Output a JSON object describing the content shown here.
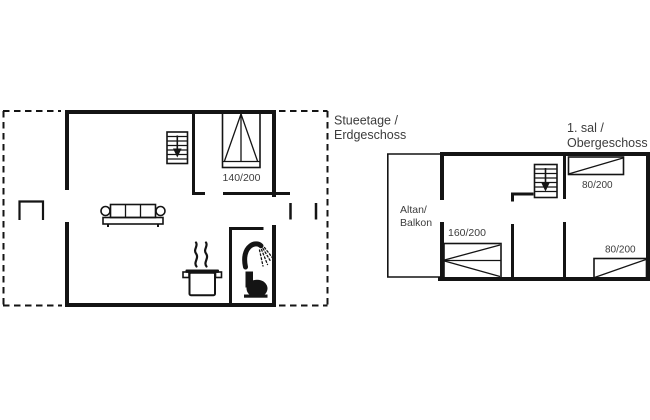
{
  "document": {
    "type": "vacation-house floor plan, two storeys",
    "background_color": "#ffffff",
    "line_color": "#141414",
    "text_color": "#3c3c3c"
  },
  "ground_floor": {
    "title": [
      "Stueetage /",
      "Erdgeschoss"
    ],
    "bed_size": "140/200"
  },
  "upper_floor": {
    "title": [
      "1. sal /",
      "Obergeschoss"
    ],
    "balcony_label": [
      "Altan/",
      "Balkon"
    ],
    "bed_sizes": {
      "bedroom_right_top": "80/200",
      "bedroom_right_bottom": "80/200",
      "bedroom_left": "160/200"
    }
  },
  "icons": {
    "stairs_down": "staircase with down arrow",
    "double_bed": "double bed, top view",
    "single_bed": "single bed, top view",
    "sofa": "three-seat sofa",
    "cooking_pot": "steaming pot (kitchen)",
    "shower": "shower head with spray (bathroom)",
    "toilet": "toilet silhouette (bathroom)"
  }
}
